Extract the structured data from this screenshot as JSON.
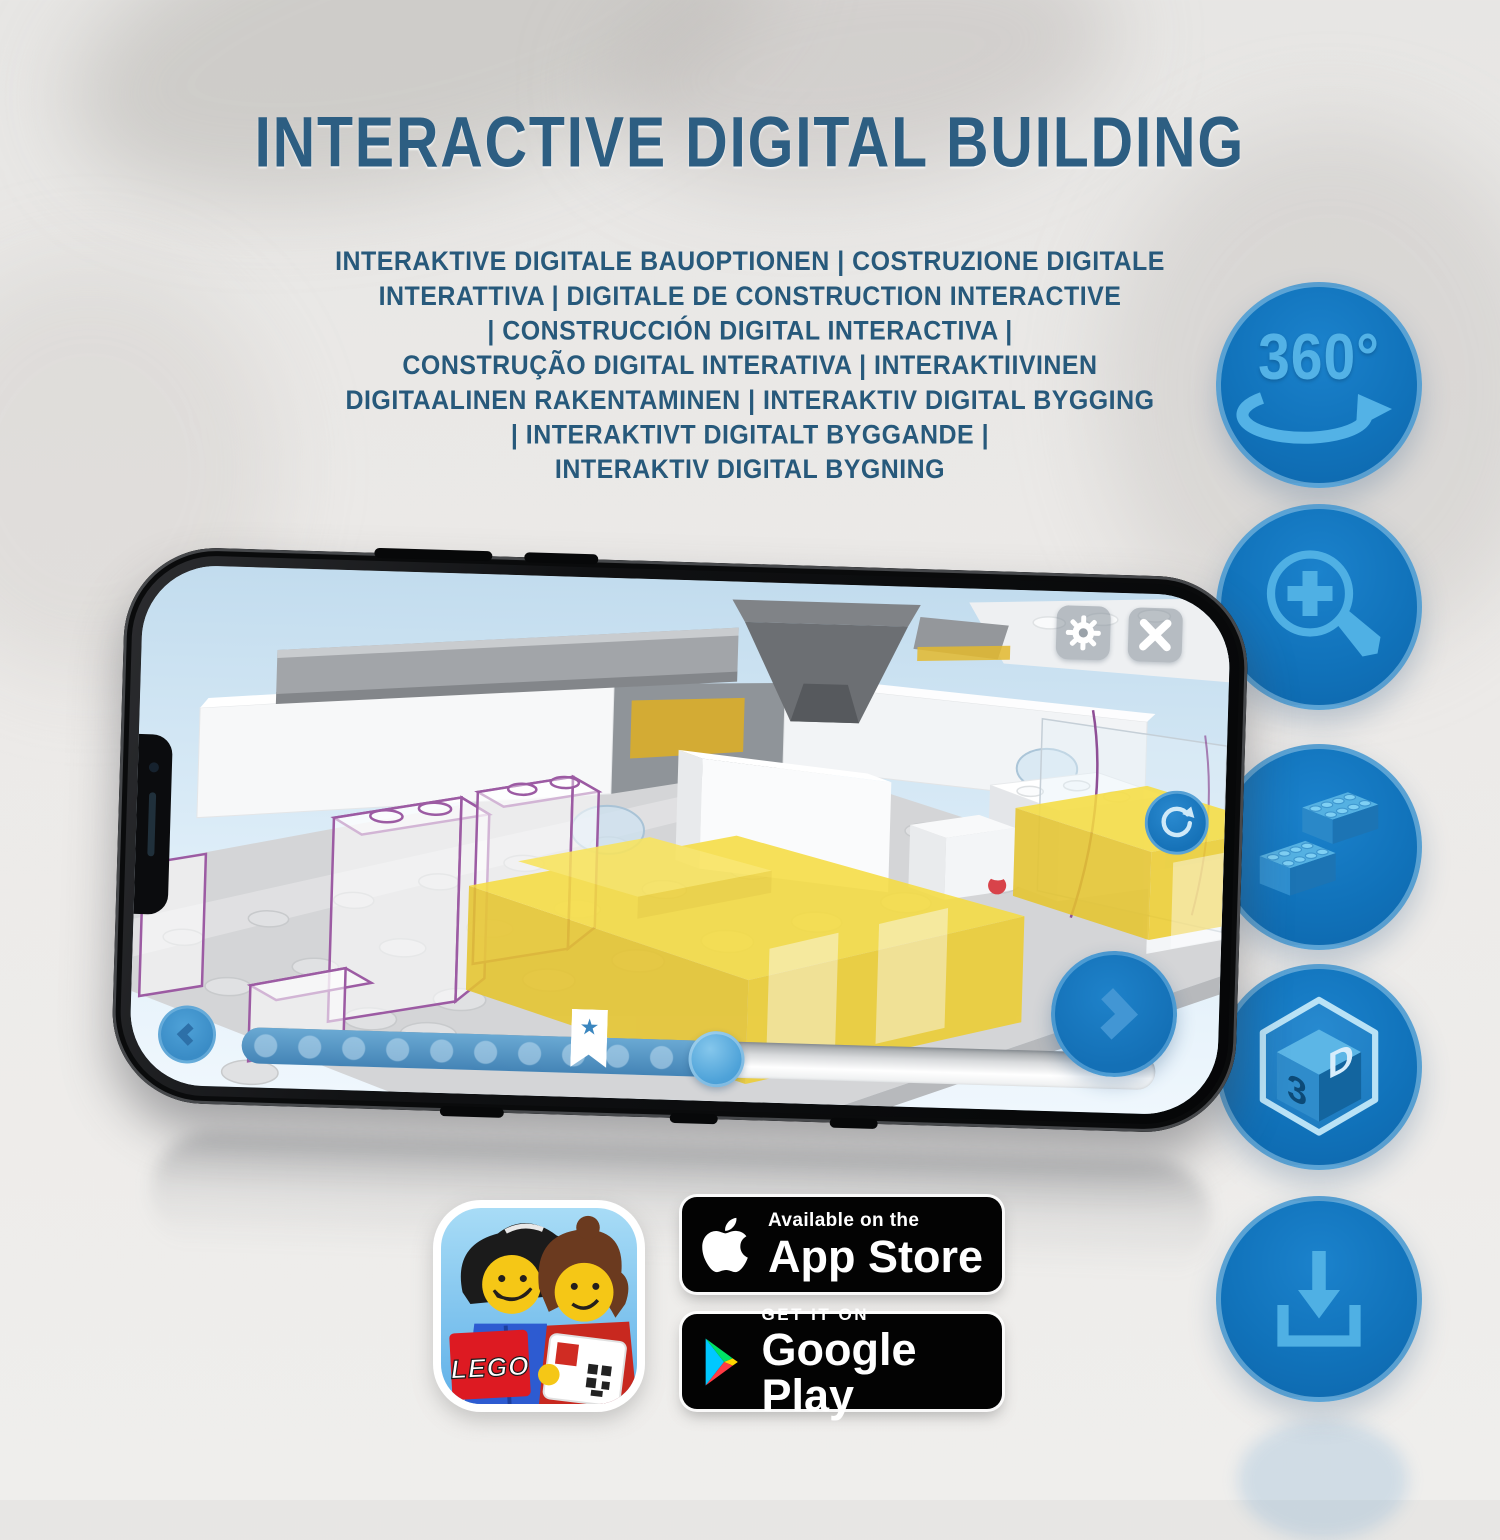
{
  "header": {
    "title": "INTERACTIVE DIGITAL BUILDING",
    "subtitle_lines": [
      "INTERAKTIVE DIGITALE BAUOPTIONEN | COSTRUZIONE DIGITALE",
      "INTERATTIVA | DIGITALE DE CONSTRUCTION INTERACTIVE",
      "| CONSTRUCCIÓN DIGITAL INTERACTIVA |",
      "CONSTRUÇÃO DIGITAL INTERATIVA | INTERAKTIIVINEN",
      "DIGITAALINEN RAKENTAMINEN | INTERAKTIV DIGITAL BYGGING",
      "| INTERAKTIVT DIGITALT BYGGANDE |",
      "INTERAKTIV DIGITAL BYGNING"
    ]
  },
  "features": [
    {
      "name": "rotate-360",
      "label": "360°"
    },
    {
      "name": "zoom-in",
      "label": ""
    },
    {
      "name": "brick",
      "label": ""
    },
    {
      "name": "3d-view",
      "letters": [
        "3",
        "D"
      ]
    },
    {
      "name": "download",
      "label": ""
    }
  ],
  "phone_app": {
    "progress_percent": 52,
    "bookmark_percent": 36,
    "bookmark_star": "★"
  },
  "store": {
    "app_store": {
      "line1": "Available on the",
      "line2": "App Store"
    },
    "google_play": {
      "line1": "GET IT ON",
      "line2": "Google Play"
    }
  },
  "app_icon": {
    "lego_logo_text": "LEGO"
  },
  "colors": {
    "title_blue": "#2d5e82",
    "subtitle_blue": "#27597b",
    "circle_blue": "#1173bb",
    "icon_light_blue": "#53b2e6",
    "app_ui_blue": "#1672b8",
    "brick_yellow": "#f6dd41",
    "badge_black": "#030303"
  }
}
